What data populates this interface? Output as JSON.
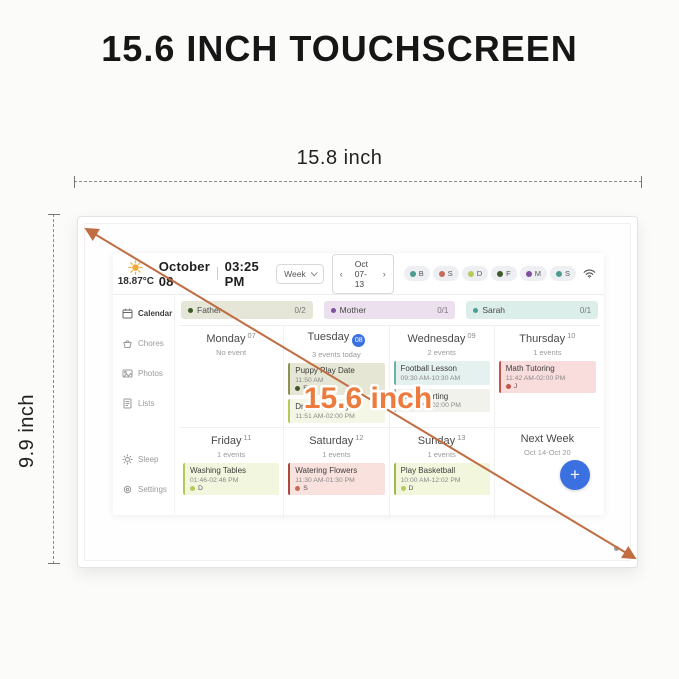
{
  "headline": "15.6 INCH TOUCHSCREEN",
  "dimensions": {
    "width": "15.8 inch",
    "height": "9.9 inch",
    "diagonal": "15.6 inch"
  },
  "colors": {
    "accent_blue": "#3a70e0",
    "arrow_orange": "#c06d43",
    "diagonal_label_orange": "#ed7b3d"
  },
  "app": {
    "weather": {
      "temperature": "18.87°C",
      "icon": "sun-icon"
    },
    "header": {
      "date": "October 08",
      "time": "03:25 PM",
      "view": "Week",
      "range": "Oct 07-13",
      "prev": "‹",
      "next": "›",
      "avatars": [
        {
          "initial": "B",
          "color": "#4a9d8f"
        },
        {
          "initial": "S",
          "color": "#c96b5b"
        },
        {
          "initial": "D",
          "color": "#b6c95a"
        },
        {
          "initial": "F",
          "color": "#3c5a2a"
        },
        {
          "initial": "M",
          "color": "#7d4f9c"
        },
        {
          "initial": "S",
          "color": "#4a9d8f"
        }
      ]
    },
    "sidebar": {
      "items": [
        {
          "label": "Calendar",
          "icon": "calendar-icon"
        },
        {
          "label": "Chores",
          "icon": "chores-icon"
        },
        {
          "label": "Photos",
          "icon": "photos-icon"
        },
        {
          "label": "Lists",
          "icon": "lists-icon"
        },
        {
          "label": "Sleep",
          "icon": "sleep-icon"
        },
        {
          "label": "Settings",
          "icon": "settings-icon"
        }
      ]
    },
    "chores": [
      {
        "name": "Father",
        "count": "0/2"
      },
      {
        "name": "Mother",
        "count": "0/1"
      },
      {
        "name": "Sarah",
        "count": "0/1"
      }
    ],
    "days": [
      {
        "name": "Monday",
        "num": "07",
        "sub": "No event"
      },
      {
        "name": "Tuesday",
        "num": "08",
        "sub": "3 events today"
      },
      {
        "name": "Wednesday",
        "num": "09",
        "sub": "2 events"
      },
      {
        "name": "Thursday",
        "num": "10",
        "sub": "1 events"
      },
      {
        "name": "Friday",
        "num": "11",
        "sub": "1 events"
      },
      {
        "name": "Saturday",
        "num": "12",
        "sub": "1 events"
      },
      {
        "name": "Sunday",
        "num": "13",
        "sub": "1 events"
      },
      {
        "name": "Next Week",
        "sub": "Oct 14-Oct 20"
      }
    ],
    "events": {
      "tuesday": [
        {
          "title": "Puppy Play Date",
          "time": "11:50 AM",
          "person": "F"
        },
        {
          "title": "Drying Laundry",
          "time": "11:51 AM-02:00 PM"
        }
      ],
      "wednesday": [
        {
          "title": "Football Lesson",
          "time": "09:30 AM-10:30 AM"
        },
        {
          "title": "Trash Sorting",
          "time": "01:00 PM-02:00 PM"
        }
      ],
      "thursday": [
        {
          "title": "Math Tutoring",
          "time": "11:42 AM-02:00 PM",
          "person": "J"
        }
      ],
      "friday": [
        {
          "title": "Washing Tables",
          "time": "01:46-02:46 PM",
          "person": "D"
        }
      ],
      "saturday": [
        {
          "title": "Watering Flowers",
          "time": "11:30 AM-01:30 PM",
          "person": "S"
        }
      ],
      "sunday": [
        {
          "title": "Play Basketball",
          "time": "10:00 AM-12:02 PM",
          "person": "D"
        }
      ]
    },
    "fab": "+"
  }
}
